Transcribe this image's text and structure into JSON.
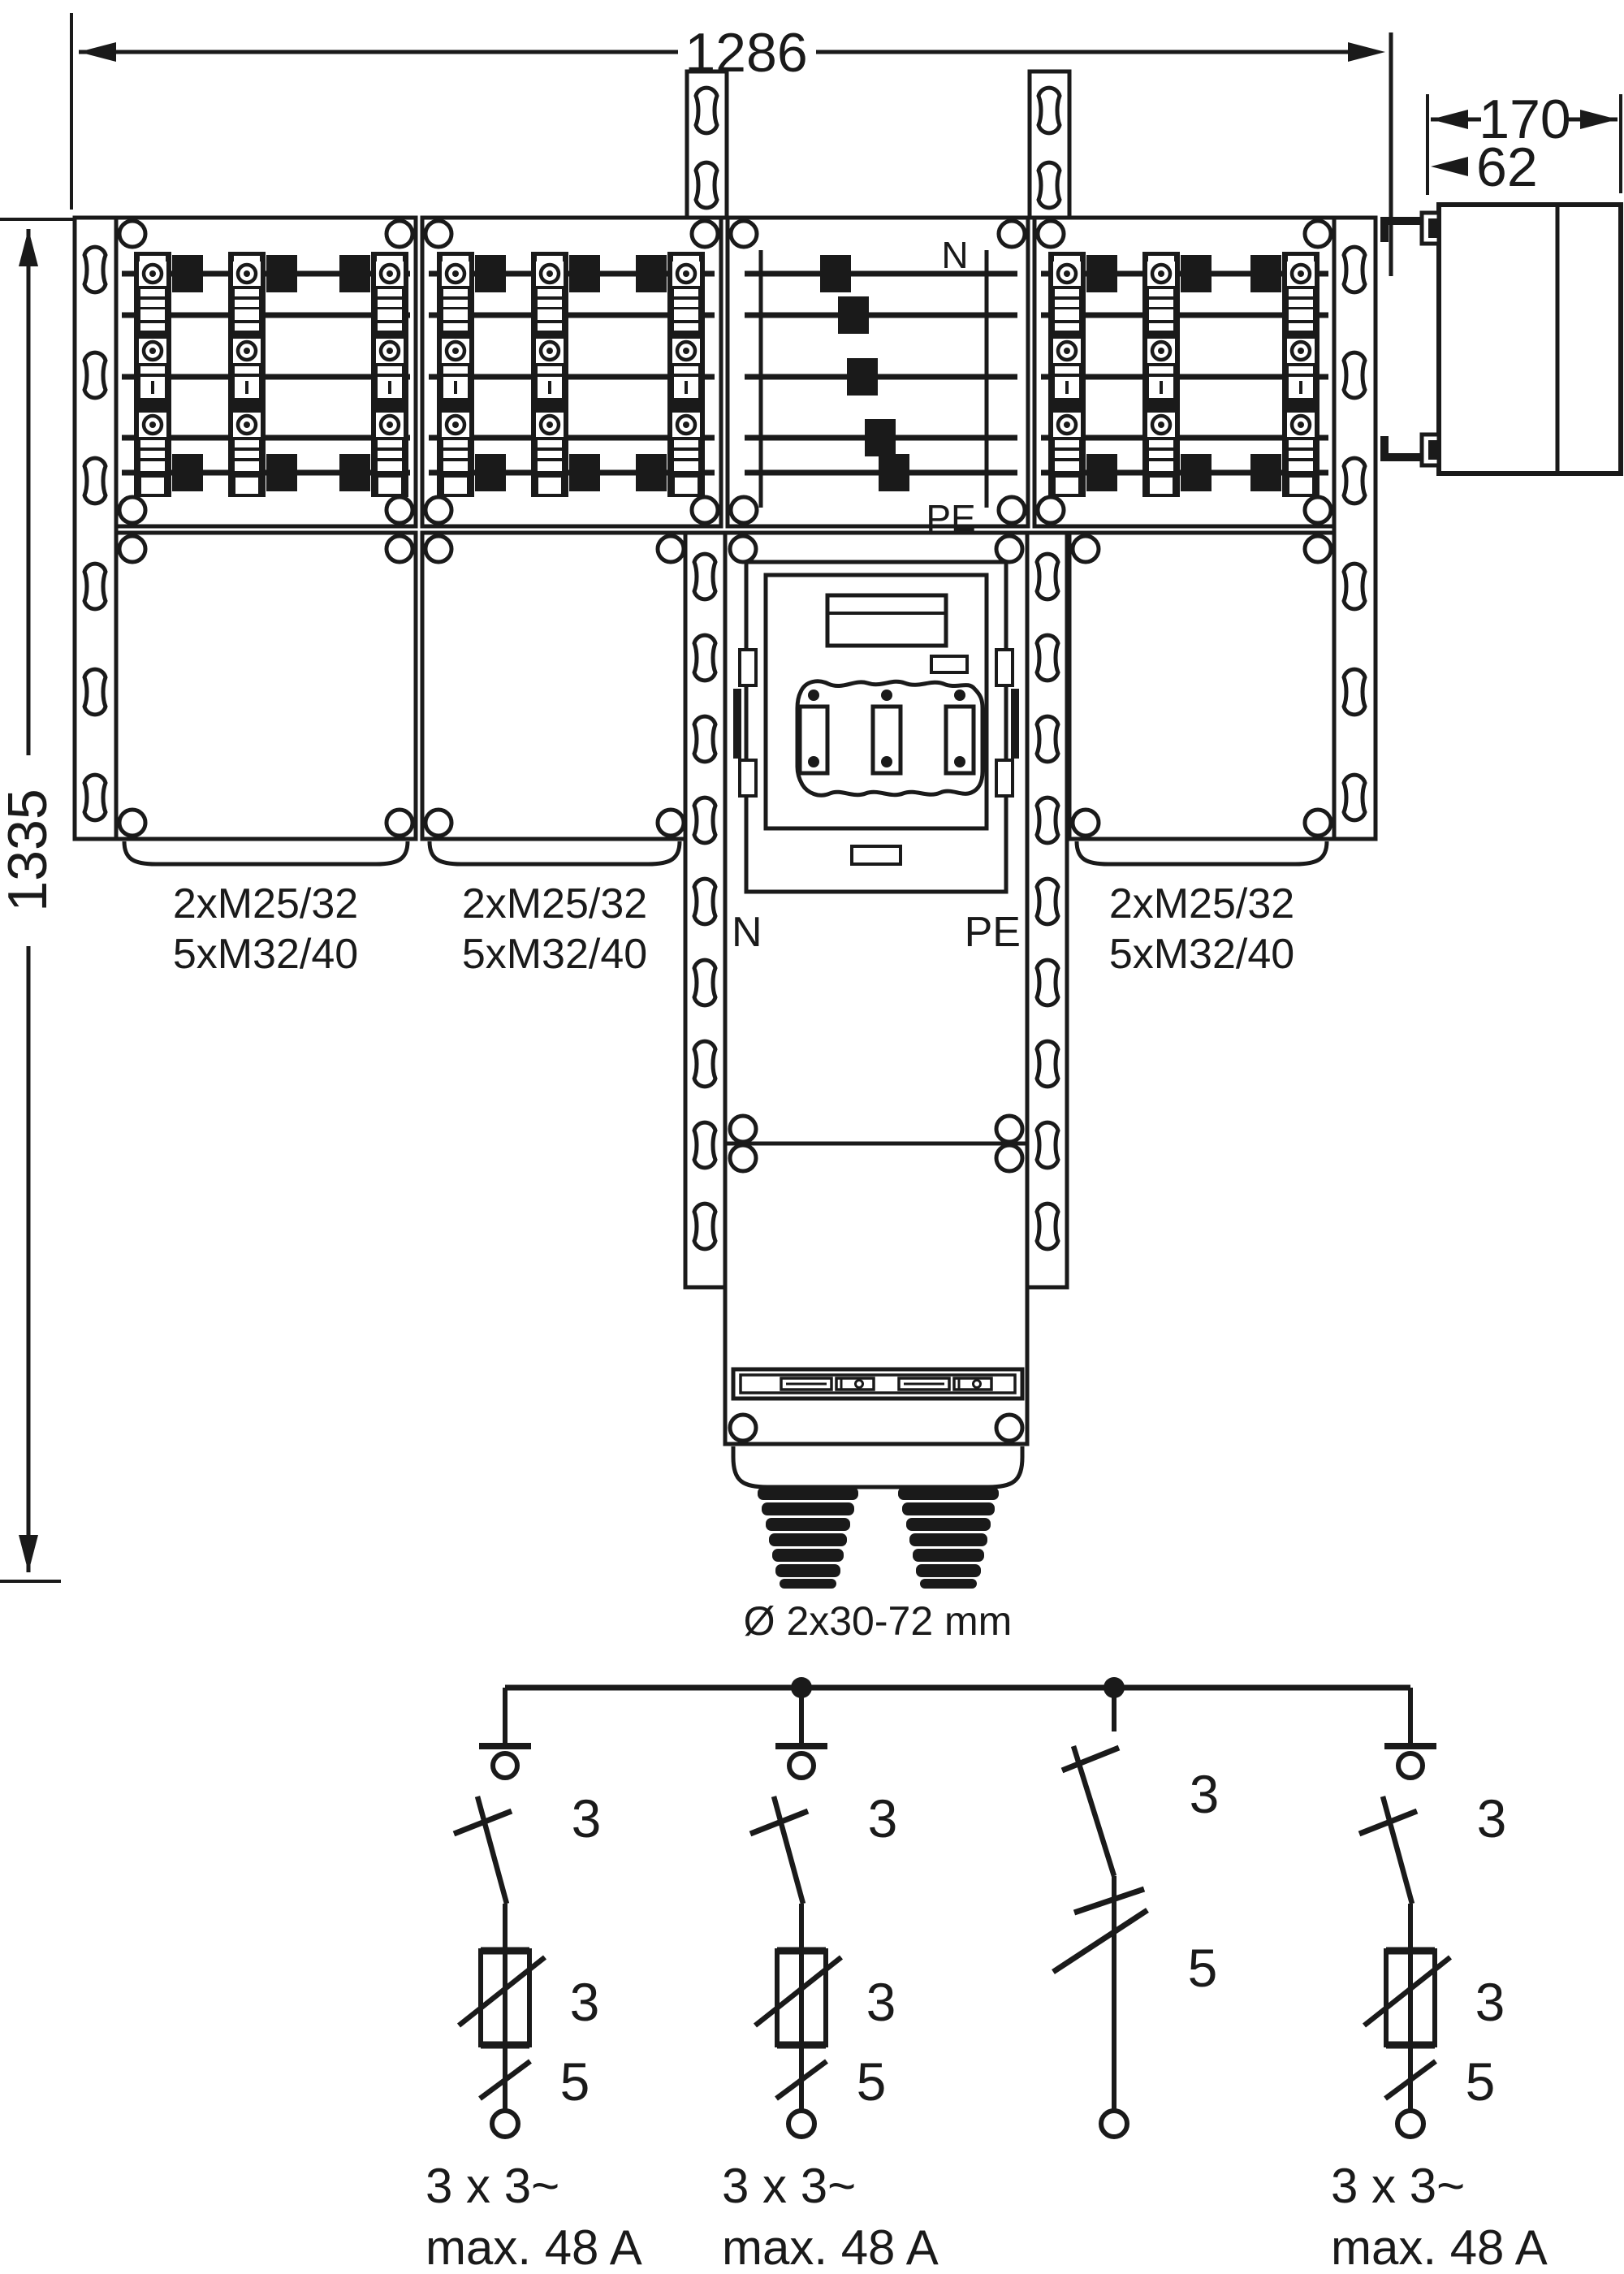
{
  "dimensions": {
    "width": "1286",
    "height": "1335",
    "depth": "170",
    "offset": "62"
  },
  "top_view_labels": {
    "neutral": "N",
    "earth": "PE"
  },
  "center_labels": {
    "neutral": "N",
    "earth": "PE"
  },
  "cable_entries": [
    {
      "line1": "2xM25/32",
      "line2": "5xM32/40"
    },
    {
      "line1": "2xM25/32",
      "line2": "5xM32/40"
    },
    {
      "line1": "2xM25/32",
      "line2": "5xM32/40"
    }
  ],
  "gland_label": "Ø 2x30-72 mm",
  "schematic": {
    "branches": [
      {
        "switch_poles": "3",
        "fuse_poles": "3",
        "outlet_poles": "5",
        "rating_line1": "3 x 3~",
        "rating_line2": "max. 48 A"
      },
      {
        "switch_poles": "3",
        "fuse_poles": "3",
        "outlet_poles": "5",
        "rating_line1": "3 x 3~",
        "rating_line2": "max. 48 A"
      },
      {
        "switch_poles": "3",
        "outlet_poles": "5"
      },
      {
        "switch_poles": "3",
        "fuse_poles": "3",
        "outlet_poles": "5",
        "rating_line1": "3 x 3~",
        "rating_line2": "max. 48 A"
      }
    ]
  }
}
